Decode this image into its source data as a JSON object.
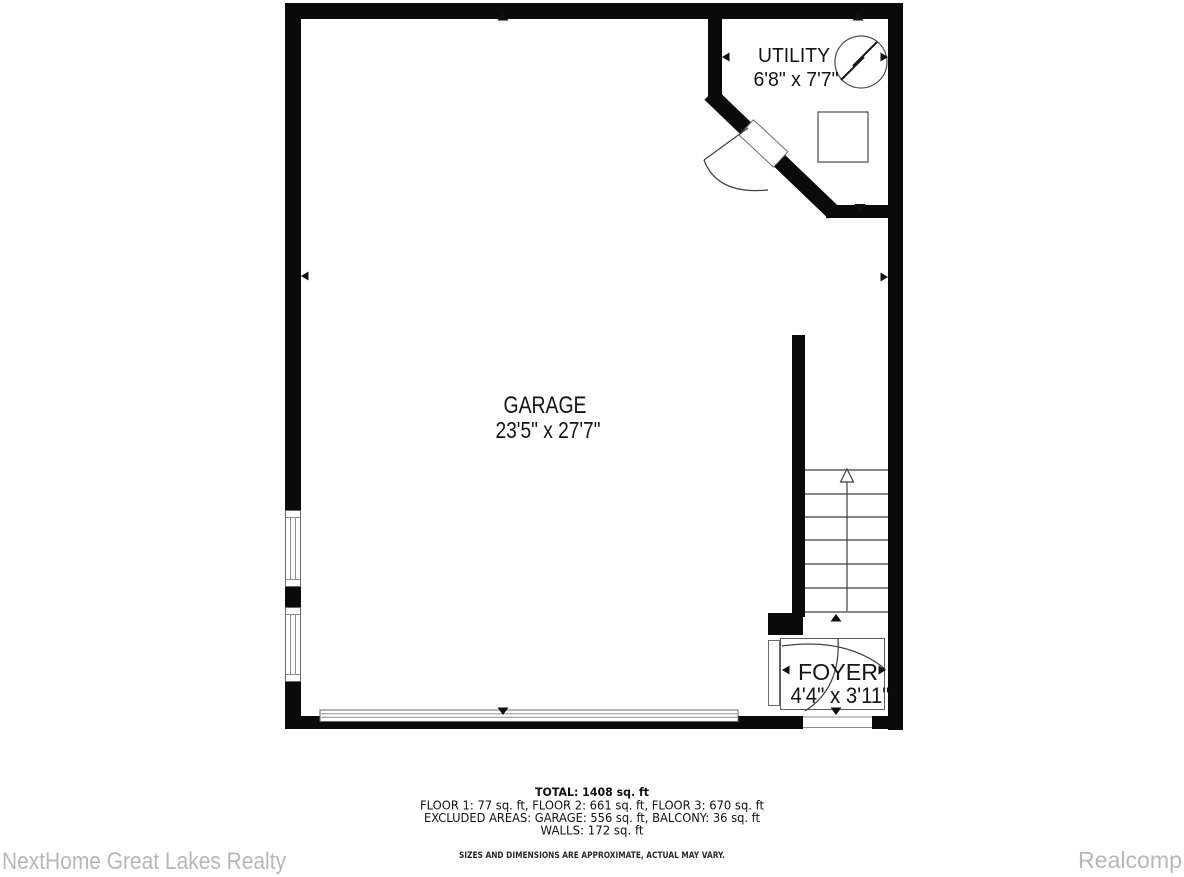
{
  "plan": {
    "rooms": [
      {
        "name": "UTILITY",
        "dims": "6'8\" x 7'7\""
      },
      {
        "name": "GARAGE",
        "dims": "23'5\" x 27'7\""
      },
      {
        "name": "FOYER",
        "dims": "4'4\" x 3'11\""
      }
    ],
    "stairs": {
      "treads": 6,
      "direction": "up"
    },
    "symbols": {
      "electrical": "electrical-panel",
      "appliance": "square-fixture"
    },
    "summary": {
      "total": "TOTAL: 1408 sq. ft",
      "floors": "FLOOR 1: 77 sq. ft, FLOOR 2: 661 sq. ft, FLOOR 3: 670 sq. ft",
      "excluded": "EXCLUDED AREAS: GARAGE: 556 sq. ft, BALCONY: 36 sq. ft",
      "walls": "WALLS: 172 sq. ft"
    },
    "disclaimer": "SIZES AND DIMENSIONS ARE APPROXIMATE, ACTUAL MAY VARY.",
    "watermark_left": "NextHome Great Lakes Realty",
    "watermark_right": "Realcomp",
    "colors": {
      "wall": "#0a0a0a",
      "thin_line": "#3f3f3f",
      "watermark": "#b7b7b7",
      "background": "#ffffff"
    }
  }
}
